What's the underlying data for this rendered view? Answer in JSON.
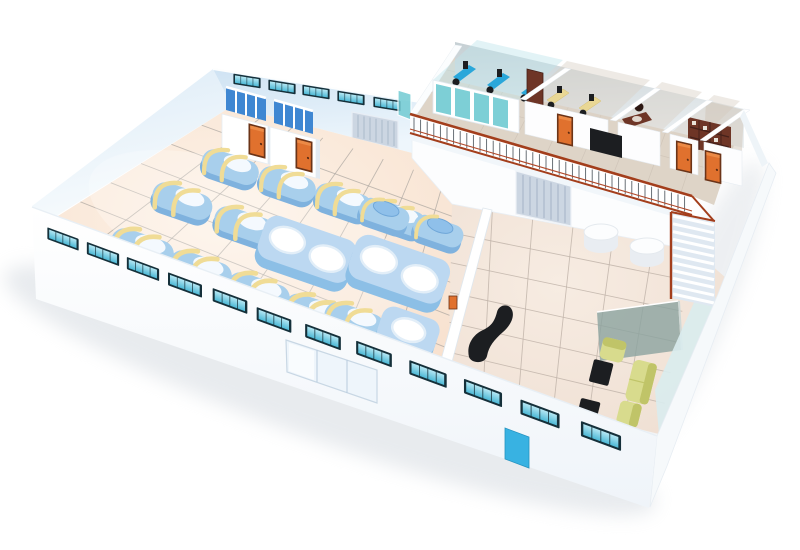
{
  "meta": {
    "description": "3D isometric cutaway rendering of a factory building floor plan with a production hall, lobby and mezzanine offices",
    "image_type": "architectural 3D rendering",
    "visible_text": "none"
  },
  "palette": {
    "wall": "#ffffff",
    "wallEdge": "#e3ebf2",
    "floorFactory": "#f8e4d4",
    "floorLobby": "#f2e3d7",
    "floorMezz": "#ded4c7",
    "tileFactory": "#a9a49e",
    "tileLobby": "#bfb2a8",
    "tileMezz": "#c7bcb0",
    "machine": "#a8cfec",
    "machineDark": "#7fb2de",
    "machineWhite": "#fbfdff",
    "strap": "#f0dc96",
    "vat": "#8cbfe6",
    "vatTop": "#bcd8f1",
    "windowFrame": "#15303a",
    "windowPane": "#5fc2de",
    "doorOrange": "#e0712e",
    "doorFrame": "#6b3418",
    "rollerDoor": "#ccd6e2",
    "rollerLine": "#aab9cb",
    "railRed": "#a33e1c",
    "baluster": "#474f57",
    "officeGlass": "#72cbd3",
    "deskBlue": "#2aa7da",
    "deskYellow": "#e9d795",
    "wood": "#6e3526",
    "woodDark": "#45211a",
    "black": "#1c1e21",
    "sofa": "#d8db8d",
    "sofaDark": "#c0c468",
    "partitionGlass": "#8ba39f",
    "cyanDoor": "#38b2e2",
    "stairBase": "#dfe8f1",
    "shadow": "#c9d0d8",
    "stall": "#3f87d2",
    "mezzWall": "#cdd6d9"
  },
  "scene": {
    "ground_floor": {
      "production_hall": {
        "floor": "peach ceramic tile grid",
        "machines": [
          {
            "type": "strapped-tank",
            "count": 11,
            "body_color": "#a8cfec",
            "strap_color": "#f0dc96"
          },
          {
            "type": "lidded-mixer",
            "count": 2,
            "body_color": "#8fc0ea"
          },
          {
            "type": "twin-vat-unit",
            "count": 2,
            "vat_color": "#ffffff"
          },
          {
            "type": "single-vat-unit",
            "count": 1
          }
        ],
        "washroom_blocks": {
          "count": 2,
          "stalls_per_block": 3,
          "stall_color": "#3f87d2",
          "door_color": "#e0712e"
        },
        "back_wall_windows": 5,
        "roller_shutter_doors_back_wall": 1
      },
      "lobby": {
        "floor": "peach ceramic tile grid",
        "round_tables": 2,
        "reception_desk": "black curved counter",
        "under_mezzanine_roller_door": 1,
        "divider_wall_item": "orange wall-mounted sign",
        "lounge": {
          "sofa_seats": 3,
          "sofa_color": "#d8db8d",
          "black_coffee_tables": 2,
          "glass_partition": 1
        },
        "staircase": {
          "steps": 11,
          "stringer_color": "#a33e1c"
        }
      },
      "front_wall": {
        "windows": 12,
        "glass_entrance_panels": 3,
        "service_door_color": "#38b2e2"
      }
    },
    "mezzanine": {
      "railing": {
        "style": "ornamental wrought iron",
        "rail_color": "#a33e1c",
        "baluster_color": "#474f57"
      },
      "offices": [
        {
          "name": "open-plan computer office",
          "front": "teal glass panels",
          "workstations": 3,
          "workstation_color": "#2aa7da"
        },
        {
          "name": "staff office",
          "desks": 2,
          "desk_color": "#e9d795",
          "tall_cabinet": 1,
          "door": "orange"
        },
        {
          "name": "manager office",
          "furniture": "dark wood executive desk and chair"
        },
        {
          "name": "meeting room",
          "door": "orange"
        },
        {
          "name": "archive room",
          "shelving": "wall bookshelf",
          "door": "orange"
        }
      ],
      "orange_doors": 3,
      "black_corridor_cabinet": 1
    }
  }
}
